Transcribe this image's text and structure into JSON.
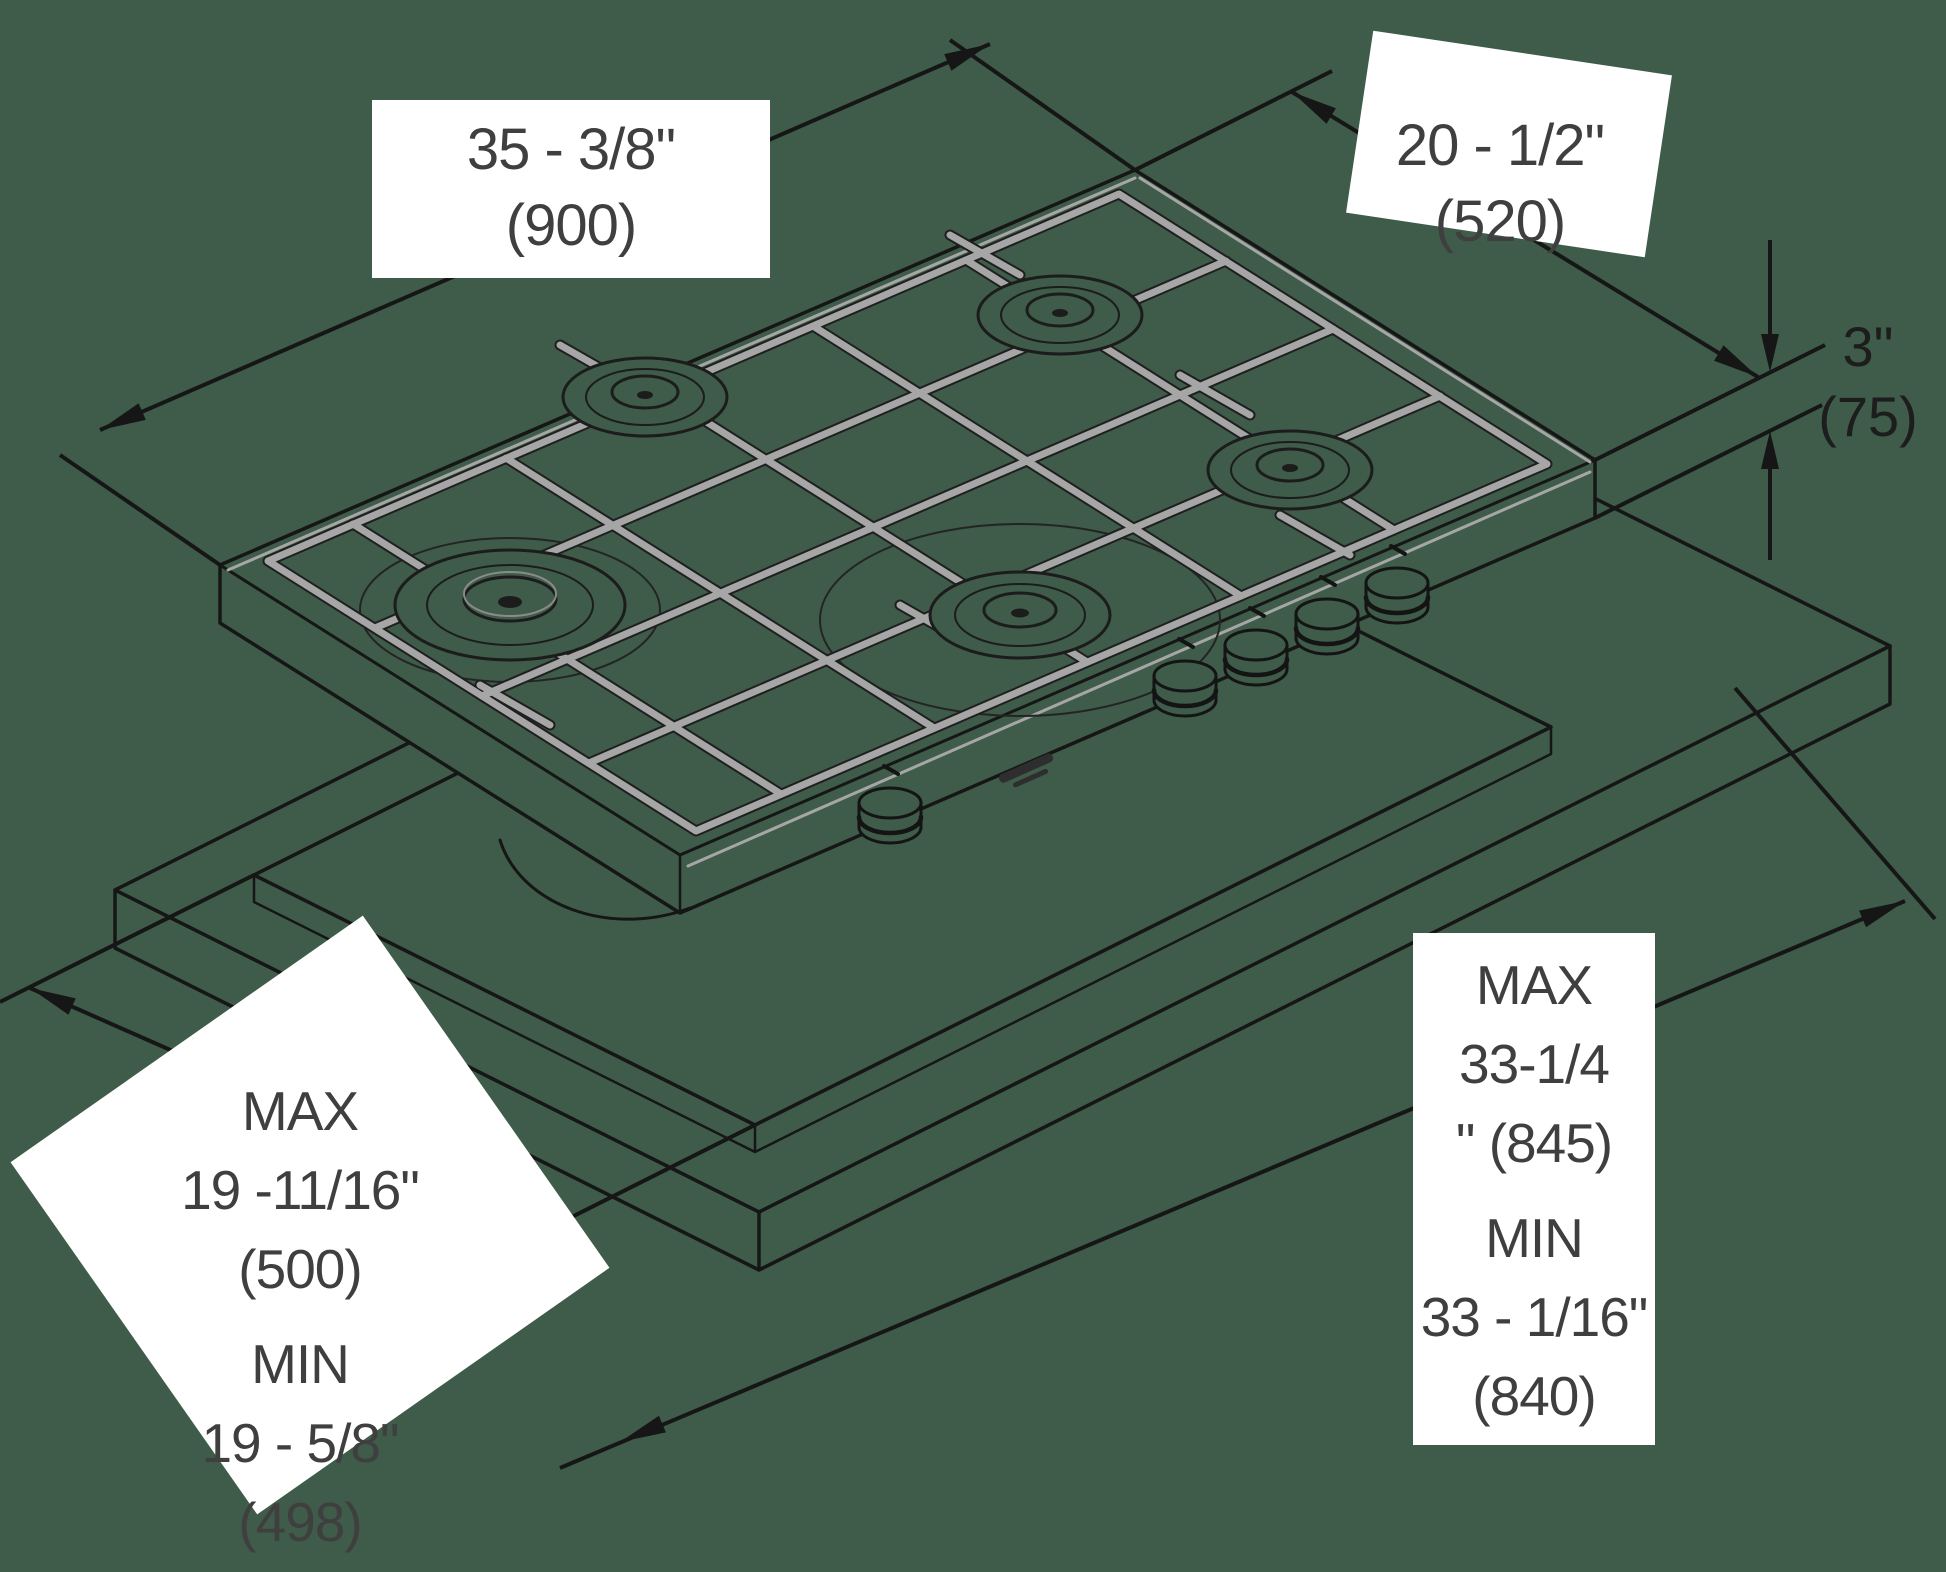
{
  "figure": {
    "kind": "isometric installation drawing",
    "subject": "gas cooktop with five burners and control knobs above a countertop with rectangular cutout",
    "units_note": "inches with millimeters in parentheses"
  },
  "colors": {
    "background": "#3E5C49",
    "line": "#161616",
    "grate_gray": "#A6A6A6",
    "label_background": "#FFFFFF",
    "label_text": "#3F3F3F"
  },
  "labels": {
    "cooktop_width": {
      "lines": [
        "35 - 3/8\"",
        "(900)"
      ]
    },
    "cooktop_depth": {
      "lines": [
        "20 - 1/2\"",
        "(520)"
      ]
    },
    "edge_thickness": {
      "lines": [
        "3\"",
        "(75)"
      ]
    },
    "cutout_length": {
      "lines": [
        "MAX",
        "33-1/4",
        "\" (845)",
        "MIN",
        "33 - 1/16\"",
        "(840)"
      ]
    },
    "cutout_width": {
      "lines": [
        "MAX",
        "19 -11/16\"",
        "(500)",
        "MIN",
        "19 - 5/8\"",
        "(498)"
      ]
    }
  }
}
